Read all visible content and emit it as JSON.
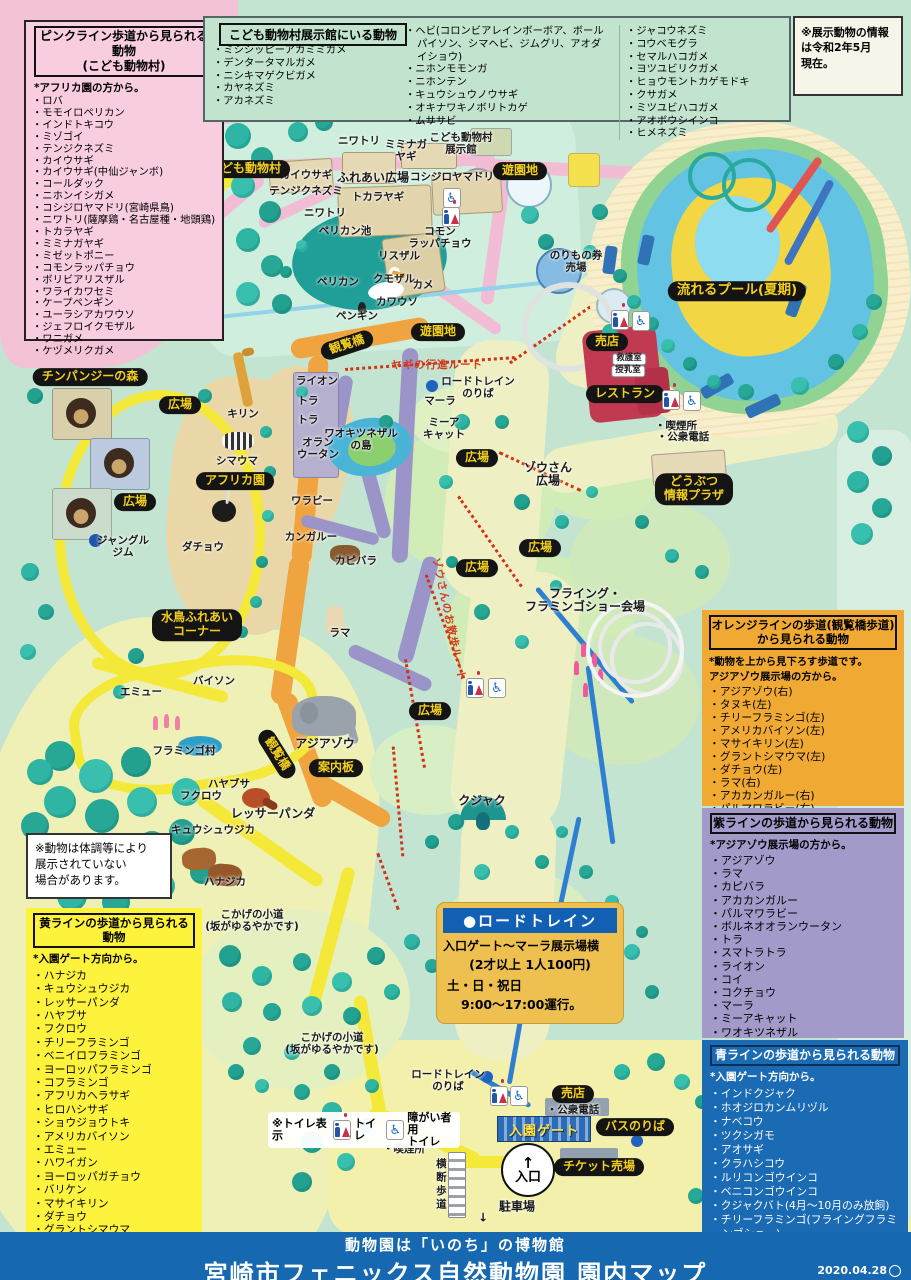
{
  "legends": {
    "pink": {
      "title1": "ピンクライン歩道から見られる動物",
      "title2": "(こども動物村)",
      "note": "*アフリカ園の方から。",
      "items": [
        "ロバ",
        "モモイロペリカン",
        "インドトキコウ",
        "ミゾゴイ",
        "テンジクネズミ",
        "カイウサギ",
        "カイウサギ(中仙ジャンボ)",
        "コールダック",
        "ニホンイシガメ",
        "コシジロヤマドリ(宮崎県鳥)",
        "ニワトリ(薩摩鶏・名古屋種・地頭鶏)",
        "トカラヤギ",
        "ミミナガヤギ",
        "ミゼットポニー",
        "コモンラッパチョウ",
        "ボリビアリスザル",
        "ワライカワセミ",
        "ケープペンギン",
        "ユーラシアカワウソ",
        "ジェフロイクモザル",
        "ワニガメ",
        "ケヅメリクガメ"
      ]
    },
    "exhibit": {
      "title": "こども動物村展示館にいる動物",
      "col1": [
        "ミシシッピーアカミミガメ",
        "デンタータマルガメ",
        "ニシキマゲクビガメ",
        "カヤネズミ",
        "アカネズミ"
      ],
      "col2": [
        "ヘビ(コロンビアレインボーボア、ボールパイソン、シマヘビ、ジムグリ、アオダイショウ)",
        "ニホンモモンガ",
        "ニホンテン",
        "キュウシュウノウサギ",
        "オキナワキノボリトカゲ",
        "ムササビ"
      ],
      "col3": [
        "ジャコウネズミ",
        "コウベモグラ",
        "セマルハコガメ",
        "ヨツユビリクガメ",
        "ヒョウモントカゲモドキ",
        "クサガメ",
        "ミツユビハコガメ",
        "アオボウシインコ",
        "ヒメネズミ"
      ]
    },
    "orange": {
      "title1": "オレンジラインの歩道(観覧橋歩道)",
      "title2": "から見られる動物",
      "note": "*動物を上から見下ろす歩道です。\nアジアゾウ展示場の方から。",
      "items": [
        "アジアゾウ(右)",
        "タヌキ(左)",
        "チリーフラミンゴ(左)",
        "アメリカバイソン(左)",
        "マサイキリン(左)",
        "グラントシマウマ(左)",
        "ダチョウ(左)",
        "ラマ(右)",
        "アカカンガルー(右)",
        "パルマワラビー(右)"
      ]
    },
    "purple": {
      "title": "紫ラインの歩道から見られる動物",
      "note": "*アジアゾウ展示場の方から。",
      "items": [
        "アジアゾウ",
        "ラマ",
        "カピバラ",
        "アカカンガルー",
        "パルマワラビー",
        "ボルネオオランウータン",
        "トラ",
        "スマトラトラ",
        "ライオン",
        "コイ",
        "コクチョウ",
        "マーラ",
        "ミーアキャット",
        "ワオキツネザル"
      ]
    },
    "blue": {
      "title": "青ラインの歩道から見られる動物",
      "note": "*入園ゲート方向から。",
      "items": [
        "インドクジャク",
        "ホオジロカンムリヅル",
        "ナベコウ",
        "ツクシガモ",
        "アオサギ",
        "クラハシコウ",
        "ルリコンゴウインコ",
        "ベニコンゴウインコ",
        "クジャクバト(4月〜10月のみ放飼)",
        "チリーフラミンゴ(フライングフラミンゴショー)"
      ]
    },
    "yellow": {
      "title": "黄ラインの歩道から見られる動物",
      "note": "*入園ゲート方向から。",
      "items": [
        "ハナジカ",
        "キュウシュウジカ",
        "レッサーパンダ",
        "ハヤブサ",
        "フクロウ",
        "チリーフラミンゴ",
        "ベニイロフラミンゴ",
        "ヨーロッパフラミンゴ",
        "コフラミンゴ",
        "アフリカヘラサギ",
        "ヒロハシサギ",
        "ショウジョウトキ",
        "アメリカバイソン",
        "エミュー",
        "ハワイガン",
        "ヨーロッパガチョウ",
        "バリケン",
        "マサイキリン",
        "ダチョウ",
        "グラントシマウマ",
        "チンパンジー"
      ]
    }
  },
  "info_note": "※展示動物の情報\nは令和2年5月\n現在。",
  "condition_note": "※動物は体調等により\n展示されていない\n場合があります。",
  "roadtrain": {
    "title": "●ロードトレイン",
    "line1": "入口ゲート〜マーラ展示場横",
    "line2": "(2才以上 1人100円)",
    "line3": "土・日・祝日",
    "line4": "9:00〜17:00運行。"
  },
  "toilet_legend": {
    "prefix": "※トイレ表示",
    "toilet": "トイレ",
    "accessible": "障がい者用\nトイレ"
  },
  "footer": {
    "sub": "動物園は「いのち」の博物館",
    "title": "宮崎市フェニックス自然動物園 園内マップ",
    "date": "2020.04.28"
  },
  "map": {
    "gate_label": "入園ゲート",
    "entrance_label": "入口",
    "labels": [
      {
        "k": "label-kodomo-village",
        "t": "こども動物村",
        "x": 245,
        "y": 169,
        "c": "pill"
      },
      {
        "k": "label-yuenchi-1",
        "t": "遊園地",
        "x": 520,
        "y": 171,
        "c": "pill"
      },
      {
        "k": "label-yuenchi-2",
        "t": "遊園地",
        "x": 438,
        "y": 332,
        "c": "pill"
      },
      {
        "k": "label-nagareru-pool",
        "t": "流れるプール(夏期)",
        "x": 737,
        "y": 291,
        "c": "pill pill-lg"
      },
      {
        "k": "label-shop-1",
        "t": "売店",
        "x": 607,
        "y": 342,
        "c": "pill"
      },
      {
        "k": "label-restaurant",
        "t": "レストラン",
        "x": 625,
        "y": 394,
        "c": "pill"
      },
      {
        "k": "label-info-plaza",
        "t": "どうぶつ\n情報プラザ",
        "x": 694,
        "y": 489,
        "c": "pill"
      },
      {
        "k": "label-chimp-forest",
        "t": "チンパンジーの森",
        "x": 90,
        "y": 377,
        "c": "pill"
      },
      {
        "k": "label-africa-zone",
        "t": "アフリカ園",
        "x": 235,
        "y": 481,
        "c": "pill"
      },
      {
        "k": "label-mizudori-corner",
        "t": "水鳥ふれあい\nコーナー",
        "x": 197,
        "y": 625,
        "c": "pill"
      },
      {
        "k": "label-hiroba-1",
        "t": "広場",
        "x": 180,
        "y": 405,
        "c": "pill"
      },
      {
        "k": "label-hiroba-2",
        "t": "広場",
        "x": 135,
        "y": 502,
        "c": "pill"
      },
      {
        "k": "label-hiroba-3",
        "t": "広場",
        "x": 477,
        "y": 458,
        "c": "pill"
      },
      {
        "k": "label-hiroba-4",
        "t": "広場",
        "x": 540,
        "y": 548,
        "c": "pill"
      },
      {
        "k": "label-hiroba-5",
        "t": "広場",
        "x": 477,
        "y": 568,
        "c": "pill"
      },
      {
        "k": "label-hiroba-6",
        "t": "広場",
        "x": 430,
        "y": 711,
        "c": "pill"
      },
      {
        "k": "label-kanranbashi-1",
        "t": "観覧橋",
        "x": 347,
        "y": 345,
        "c": "pill",
        "r": -18
      },
      {
        "k": "label-kanranbashi-2",
        "t": "観覧橋",
        "x": 277,
        "y": 754,
        "c": "pill",
        "r": 58
      },
      {
        "k": "label-annaiban",
        "t": "案内板",
        "x": 336,
        "y": 768,
        "c": "pill"
      },
      {
        "k": "label-shop-2",
        "t": "売店",
        "x": 573,
        "y": 1094,
        "c": "pill"
      },
      {
        "k": "label-bus-stop",
        "t": "バスのりば",
        "x": 635,
        "y": 1127,
        "c": "pill"
      },
      {
        "k": "label-ticket-office",
        "t": "チケット売場",
        "x": 599,
        "y": 1167,
        "c": "pill"
      },
      {
        "k": "label-roba",
        "t": "ロバ",
        "x": 60,
        "y": 267,
        "c": "t"
      },
      {
        "k": "label-pony",
        "t": "ポニー",
        "x": 431,
        "y": 121,
        "c": "t"
      },
      {
        "k": "label-niwatori-1",
        "t": "ニワトリ",
        "x": 359,
        "y": 142,
        "c": "t"
      },
      {
        "k": "label-miminaga-yagi",
        "t": "ミミナガ\nヤギ",
        "x": 406,
        "y": 151,
        "c": "t"
      },
      {
        "k": "label-tenji-hall",
        "t": "こども動物村\n展示館",
        "x": 461,
        "y": 144,
        "c": "t"
      },
      {
        "k": "label-kaiusagi",
        "t": "カイウサギ",
        "x": 306,
        "y": 176,
        "c": "t"
      },
      {
        "k": "label-tenjiku-nezumi",
        "t": "テンジクネズミ",
        "x": 306,
        "y": 192,
        "c": "t"
      },
      {
        "k": "label-fureai-hiroba",
        "t": "ふれあい広場",
        "x": 373,
        "y": 178,
        "c": "t tb"
      },
      {
        "k": "label-koshijiro",
        "t": "コシジロヤマドリ",
        "x": 452,
        "y": 178,
        "c": "t"
      },
      {
        "k": "label-tokara-yagi",
        "t": "トカラヤギ",
        "x": 378,
        "y": 198,
        "c": "t"
      },
      {
        "k": "label-niwatori-2",
        "t": "ニワトリ",
        "x": 325,
        "y": 214,
        "c": "t"
      },
      {
        "k": "label-pelican-pond",
        "t": "ペリカン池",
        "x": 345,
        "y": 232,
        "c": "t"
      },
      {
        "k": "label-risuzaru",
        "t": "リスザル",
        "x": 399,
        "y": 257,
        "c": "t"
      },
      {
        "k": "label-komon-rappacho",
        "t": "コモン\nラッパチョウ",
        "x": 440,
        "y": 238,
        "c": "t"
      },
      {
        "k": "label-kumozaru",
        "t": "クモザル",
        "x": 394,
        "y": 280,
        "c": "t"
      },
      {
        "k": "label-kame",
        "t": "カメ",
        "x": 423,
        "y": 286,
        "c": "t"
      },
      {
        "k": "label-kawauso",
        "t": "カワウソ",
        "x": 397,
        "y": 303,
        "c": "t"
      },
      {
        "k": "label-pelican",
        "t": "ペリカン",
        "x": 338,
        "y": 283,
        "c": "t"
      },
      {
        "k": "label-penguin",
        "t": "ペンギン",
        "x": 357,
        "y": 317,
        "c": "t"
      },
      {
        "k": "label-norimono-ticket",
        "t": "のりもの券\n売場",
        "x": 576,
        "y": 262,
        "c": "t"
      },
      {
        "k": "label-kyugo-shitsu",
        "t": "救護室",
        "x": 629,
        "y": 359,
        "c": "w"
      },
      {
        "k": "label-junyu-shitsu",
        "t": "授乳室",
        "x": 628,
        "y": 371,
        "c": "w"
      },
      {
        "k": "label-kitsuen-1",
        "t": "・喫煙所",
        "x": 676,
        "y": 427,
        "c": "t"
      },
      {
        "k": "label-phone-1",
        "t": "・公衆電話",
        "x": 683,
        "y": 438,
        "c": "t"
      },
      {
        "k": "label-yagi-route",
        "t": "ヤギの行進ルート",
        "x": 437,
        "y": 366,
        "c": "lbl r"
      },
      {
        "k": "label-roadtrain-stop-1",
        "t": "ロードトレイン\nのりば",
        "x": 478,
        "y": 388,
        "c": "t"
      },
      {
        "k": "label-mara",
        "t": "マーラ",
        "x": 440,
        "y": 402,
        "c": "t"
      },
      {
        "k": "label-meerkat",
        "t": "ミーア\nキャット",
        "x": 444,
        "y": 429,
        "c": "t"
      },
      {
        "k": "label-lion",
        "t": "ライオン",
        "x": 317,
        "y": 382,
        "c": "t"
      },
      {
        "k": "label-tora-1",
        "t": "トラ",
        "x": 308,
        "y": 402,
        "c": "t"
      },
      {
        "k": "label-tora-2",
        "t": "トラ",
        "x": 308,
        "y": 421,
        "c": "t"
      },
      {
        "k": "label-orangutan",
        "t": "オラン\nウータン",
        "x": 318,
        "y": 449,
        "c": "t"
      },
      {
        "k": "label-waokitsunezaru-island",
        "t": "ワオキツネザル\nの島",
        "x": 361,
        "y": 440,
        "c": "t"
      },
      {
        "k": "label-wallaby",
        "t": "ワラビー",
        "x": 312,
        "y": 502,
        "c": "t"
      },
      {
        "k": "label-kangaroo",
        "t": "カンガルー",
        "x": 311,
        "y": 538,
        "c": "t"
      },
      {
        "k": "label-capybara",
        "t": "カピバラ",
        "x": 356,
        "y": 562,
        "c": "t"
      },
      {
        "k": "label-zousan-hiroba",
        "t": "ゾウさん\n広場",
        "x": 548,
        "y": 475,
        "c": "t tb"
      },
      {
        "k": "label-kirin",
        "t": "キリン",
        "x": 243,
        "y": 415,
        "c": "t"
      },
      {
        "k": "label-shimauma",
        "t": "シマウマ",
        "x": 237,
        "y": 462,
        "c": "t"
      },
      {
        "k": "label-jungle-gym",
        "t": "ジャングル\nジム",
        "x": 123,
        "y": 547,
        "c": "t"
      },
      {
        "k": "label-dacho",
        "t": "ダチョウ",
        "x": 203,
        "y": 548,
        "c": "t"
      },
      {
        "k": "label-llama",
        "t": "ラマ",
        "x": 340,
        "y": 634,
        "c": "t"
      },
      {
        "k": "label-emu",
        "t": "エミュー",
        "x": 141,
        "y": 693,
        "c": "t"
      },
      {
        "k": "label-bison",
        "t": "バイソン",
        "x": 214,
        "y": 682,
        "c": "t"
      },
      {
        "k": "label-flamingo-village",
        "t": "フラミンゴ村",
        "x": 184,
        "y": 752,
        "c": "t"
      },
      {
        "k": "label-asia-elephant",
        "t": "アジアゾウ",
        "x": 325,
        "y": 744,
        "c": "t tb"
      },
      {
        "k": "label-hayabusa",
        "t": "ハヤブサ",
        "x": 229,
        "y": 785,
        "c": "t"
      },
      {
        "k": "label-fukuro",
        "t": "フクロウ",
        "x": 201,
        "y": 797,
        "c": "t"
      },
      {
        "k": "label-lesser-panda",
        "t": "レッサーパンダ",
        "x": 273,
        "y": 814,
        "c": "t tb"
      },
      {
        "k": "label-kyushu-jika",
        "t": "キュウシュウジカ",
        "x": 213,
        "y": 831,
        "c": "t"
      },
      {
        "k": "label-hanajika",
        "t": "ハナジカ",
        "x": 225,
        "y": 883,
        "c": "t"
      },
      {
        "k": "label-kokage-1",
        "t": "こかげの小道\n(坂がゆるやかです)",
        "x": 252,
        "y": 921,
        "c": "t"
      },
      {
        "k": "label-kokage-2",
        "t": "こかげの小道\n(坂がゆるやかです)",
        "x": 332,
        "y": 1044,
        "c": "t"
      },
      {
        "k": "label-kujaku",
        "t": "クジャク",
        "x": 482,
        "y": 801,
        "c": "t tb"
      },
      {
        "k": "label-zou-sanpo-route",
        "t": "ゾウさんのお散歩ルート",
        "x": 448,
        "y": 620,
        "c": "lbl r",
        "r": 78
      },
      {
        "k": "label-flying-show",
        "t": "フライング・\nフラミンゴショー会場",
        "x": 585,
        "y": 601,
        "c": "t tb"
      },
      {
        "k": "label-roadtrain-stop-2",
        "t": "ロードトレイン\nのりば",
        "x": 448,
        "y": 1081,
        "c": "t"
      },
      {
        "k": "label-phone-2",
        "t": "・公衆電話",
        "x": 573,
        "y": 1111,
        "c": "t"
      },
      {
        "k": "label-kitsuen-2",
        "t": "・喫煙所",
        "x": 404,
        "y": 1150,
        "c": "t"
      },
      {
        "k": "label-odan-hodo",
        "t": "横断歩道",
        "x": 440,
        "y": 1185,
        "c": "t tv"
      },
      {
        "k": "label-parking",
        "t": "駐車場",
        "x": 517,
        "y": 1207,
        "c": "t tb"
      },
      {
        "k": "label-parking-arrow",
        "t": "↓",
        "x": 483,
        "y": 1218,
        "c": "t tb"
      }
    ],
    "icons": [
      {
        "k": "accessible-icon",
        "x": 452,
        "y": 198
      },
      {
        "k": "toilet-icon",
        "x": 451,
        "y": 217
      },
      {
        "k": "toilet-icon",
        "x": 620,
        "y": 320
      },
      {
        "k": "accessible-icon",
        "x": 641,
        "y": 321
      },
      {
        "k": "toilet-icon",
        "x": 671,
        "y": 400
      },
      {
        "k": "accessible-icon",
        "x": 692,
        "y": 401
      },
      {
        "k": "toilet-icon",
        "x": 475,
        "y": 688
      },
      {
        "k": "accessible-icon",
        "x": 497,
        "y": 688
      },
      {
        "k": "toilet-icon",
        "x": 499,
        "y": 1096
      },
      {
        "k": "accessible-icon",
        "x": 519,
        "y": 1096
      }
    ]
  }
}
